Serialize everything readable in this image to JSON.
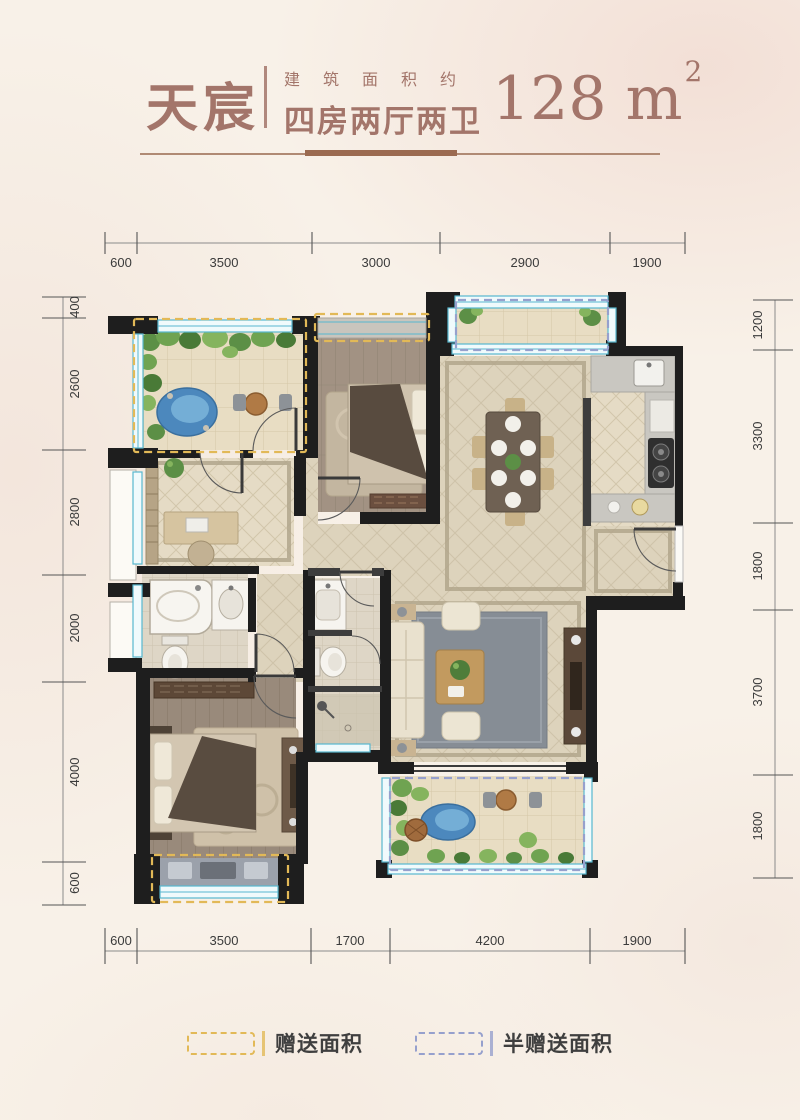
{
  "header": {
    "name": "天宸",
    "subtitle_line1": "建筑面积约",
    "subtitle_line2": "四房两厅两卫",
    "area_value": "128 m",
    "area_sup": "2"
  },
  "dims": {
    "top": [
      "600",
      "3500",
      "3000",
      "2900",
      "1900"
    ],
    "bottom": [
      "600",
      "3500",
      "1700",
      "4200",
      "1900"
    ],
    "left": [
      "400",
      "2600",
      "2800",
      "2000",
      "4000",
      "600"
    ],
    "right": [
      "1200",
      "3300",
      "1800",
      "3700",
      "1800"
    ]
  },
  "legend": {
    "gift_label": "赠送面积",
    "half_gift_label": "半赠送面积"
  },
  "colors": {
    "accent_brown": "#a3756a",
    "divider_brown": "#9b6a50",
    "wall_black": "#1e1e1e",
    "window_cyan": "#58b7cf",
    "gift_dash_yellow": "#e2b957",
    "half_gift_dash_blue": "#96a0cd",
    "page_cream": "#f8f1e8"
  }
}
